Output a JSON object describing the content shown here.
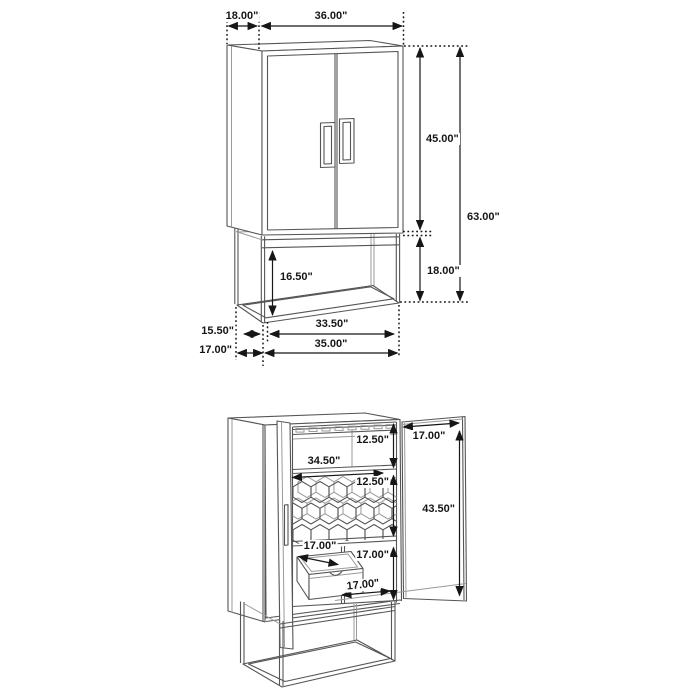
{
  "diagram": {
    "colors": {
      "background": "#ffffff",
      "furniture_line": "#555555",
      "furniture_line_light": "#9a9a9a",
      "dimension_line": "#161616",
      "dimension_text": "#161616"
    },
    "closed_view": {
      "dimensions": {
        "top_depth": "18.00\"",
        "top_width": "36.00\"",
        "door_height": "45.00\"",
        "total_height": "63.00\"",
        "base_height": "18.00\"",
        "base_inner_height": "16.50\"",
        "base_depth_inner": "15.50\"",
        "base_depth_outer": "17.00\"",
        "base_width_inner": "33.50\"",
        "base_width_outer": "35.00\""
      }
    },
    "open_view": {
      "dimensions": {
        "top_shelf_height": "12.50\"",
        "shelf_width": "34.50\"",
        "wine_rack_height": "12.50\"",
        "door_width": "17.00\"",
        "door_height": "43.50\"",
        "drawer_depth": "17.00\"",
        "lower_cabinet_height": "17.00\"",
        "lower_shelf_width": "17.00\""
      }
    }
  }
}
